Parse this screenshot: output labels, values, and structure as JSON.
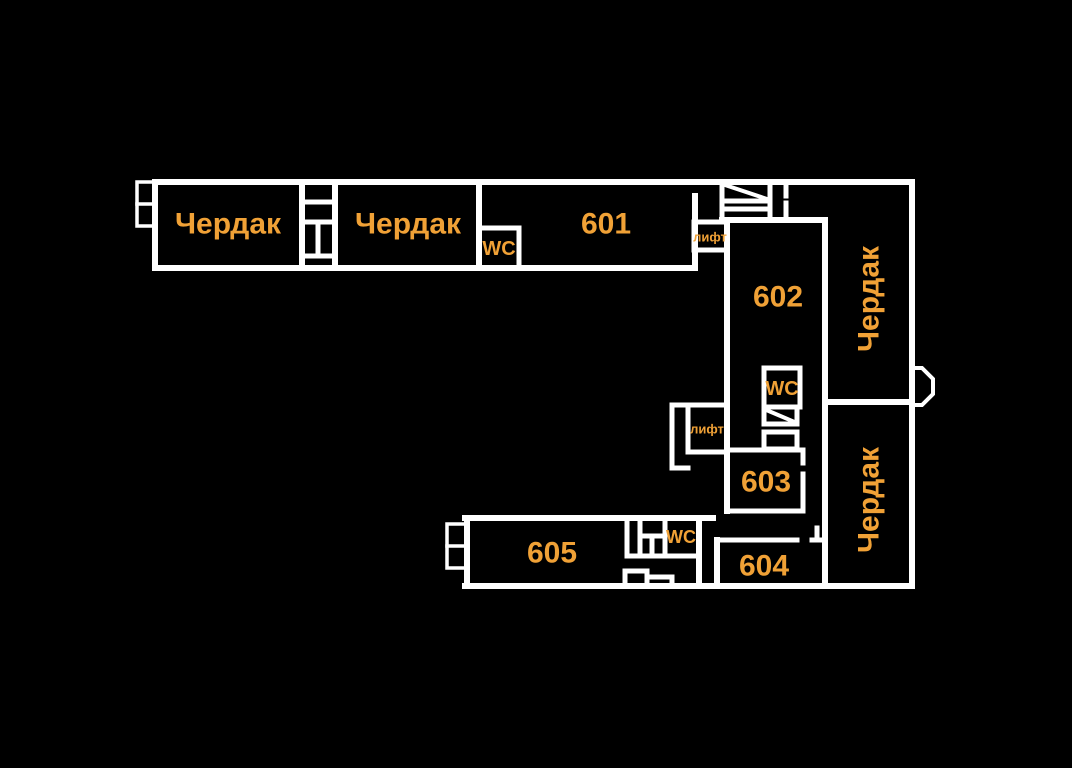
{
  "canvas": {
    "width": 1072,
    "height": 768,
    "background": "#000000",
    "wall_color": "#ffffff",
    "label_color": "#F0A136"
  },
  "labels": [
    {
      "name": "attic-top-left",
      "text": "Чердак"
    },
    {
      "name": "attic-top-middle",
      "text": "Чердак"
    },
    {
      "name": "room-601",
      "text": "601"
    },
    {
      "name": "wc-top",
      "text": "WC"
    },
    {
      "name": "lift-upper",
      "text": "лифт"
    },
    {
      "name": "room-602",
      "text": "602"
    },
    {
      "name": "wc-middle",
      "text": "WC"
    },
    {
      "name": "lift-lower",
      "text": "лифт"
    },
    {
      "name": "attic-right-upper",
      "text": "Чердак"
    },
    {
      "name": "room-603",
      "text": "603"
    },
    {
      "name": "attic-right-lower",
      "text": "Чердак"
    },
    {
      "name": "room-605",
      "text": "605"
    },
    {
      "name": "wc-bottom",
      "text": "WC"
    },
    {
      "name": "room-604",
      "text": "604"
    }
  ]
}
